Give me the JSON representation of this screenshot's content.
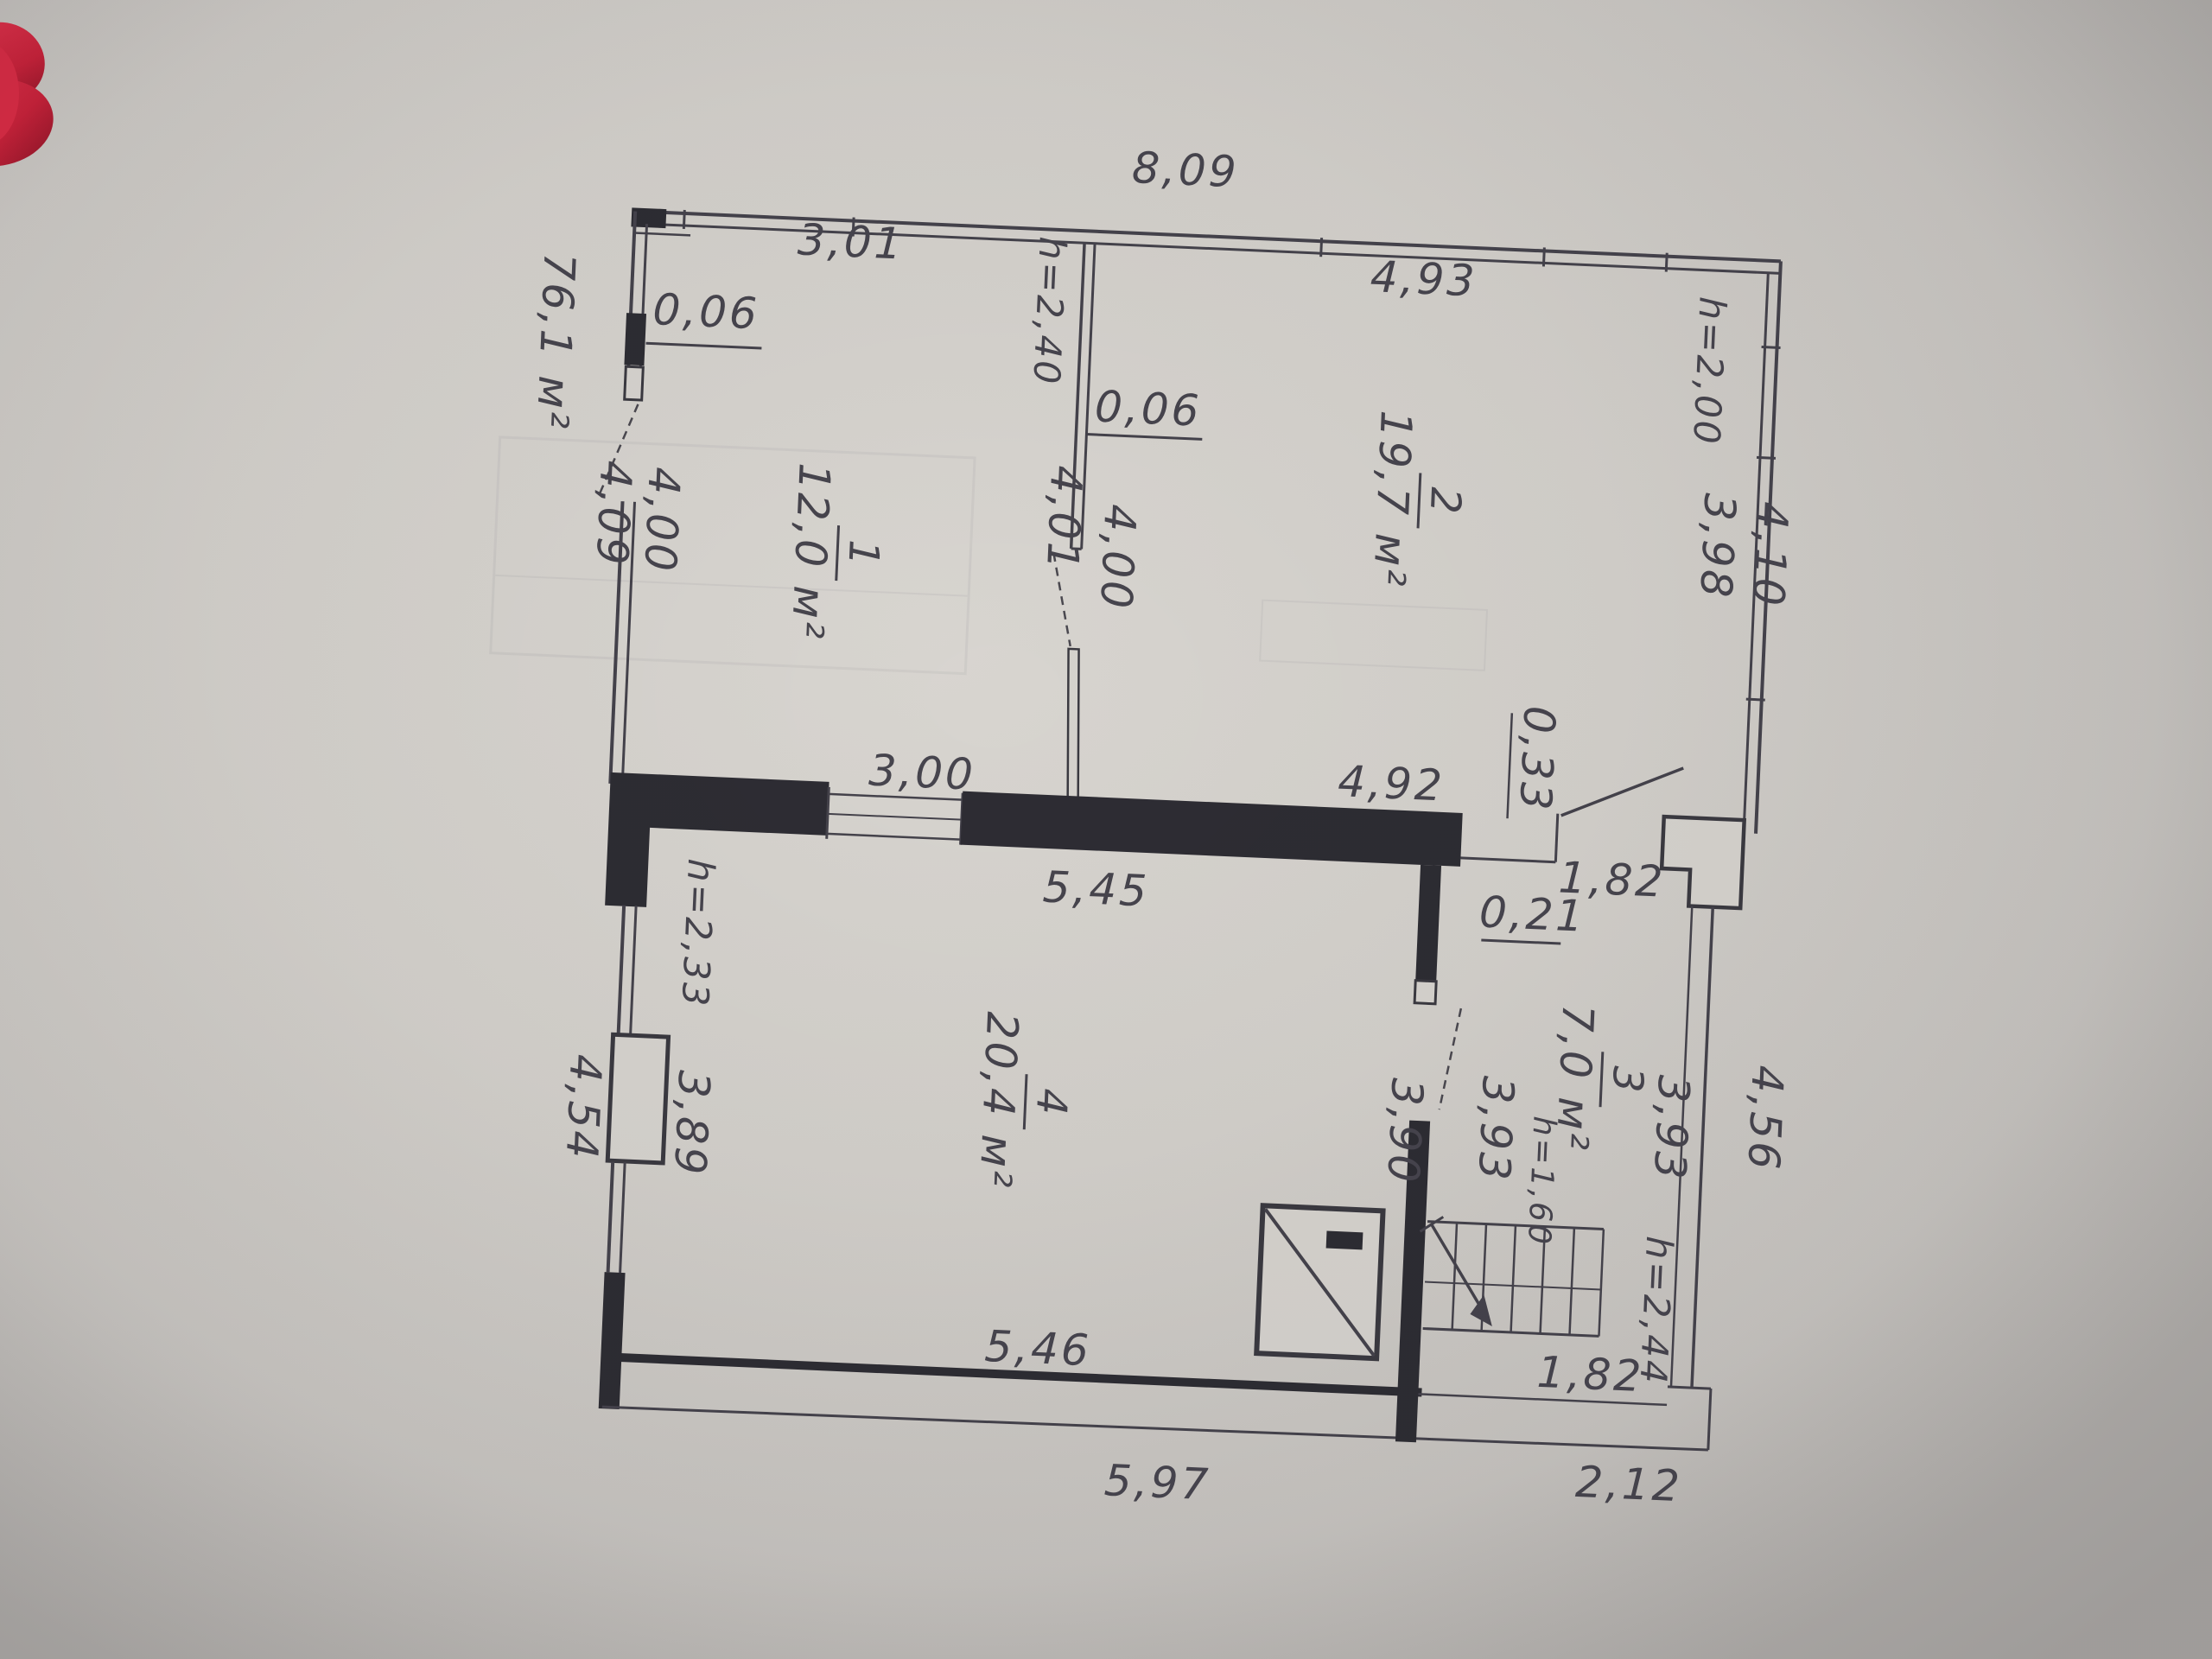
{
  "photo": {
    "subject": "hand-drafted apartment floor plan (BTI style) photographed on grey surface",
    "red_object_note": "red object edge visible at top-left corner"
  },
  "colors": {
    "paper": "#d3d0cb",
    "ink": "#46444d",
    "wall_fill": "#2d2c33",
    "red_object": "#cf2740"
  },
  "plan": {
    "total_area": "76,1 м²",
    "rooms": [
      {
        "number": "1",
        "area": "12,0 м²"
      },
      {
        "number": "2",
        "area": "19,7 м²"
      },
      {
        "number": "3",
        "area": "7,0 м²"
      },
      {
        "number": "4",
        "area": "20,4 м²"
      }
    ],
    "dims": {
      "top_overall": "8,09",
      "room1_width": "3,01",
      "offset_top_left": "0,06",
      "offset_room2": "0,06",
      "room2_width_top": "4,93",
      "height_left_wing": "h=2,40",
      "room1_height": "4,01",
      "room2_height": "4,00",
      "height_right": "h=2,00",
      "right_outer": "4,10",
      "right_inner": "3,98",
      "left_outer": "4,09",
      "left_inner": "4,00",
      "mid_window": "3,00",
      "mid_wall_span": "5,45",
      "room2_width_bottom": "4,92",
      "entry_offset": "0,33",
      "hall_width_top": "1,82",
      "hall_offset": "0,21",
      "height_lower_left": "h=2,33",
      "lower_left_outer": "4,54",
      "room4_height": "3,89",
      "room4_width_right": "3,90",
      "stair_width": "3,93",
      "stair_height_low": "h=1,60",
      "stair_height_right": "3,93",
      "height_stairwell": "h=2,44",
      "lower_right_outer": "4,56",
      "room4_width_bottom": "5,46",
      "stair_bottom": "1,82",
      "bottom_outer_left": "5,97",
      "bottom_outer_right": "2,12"
    }
  }
}
